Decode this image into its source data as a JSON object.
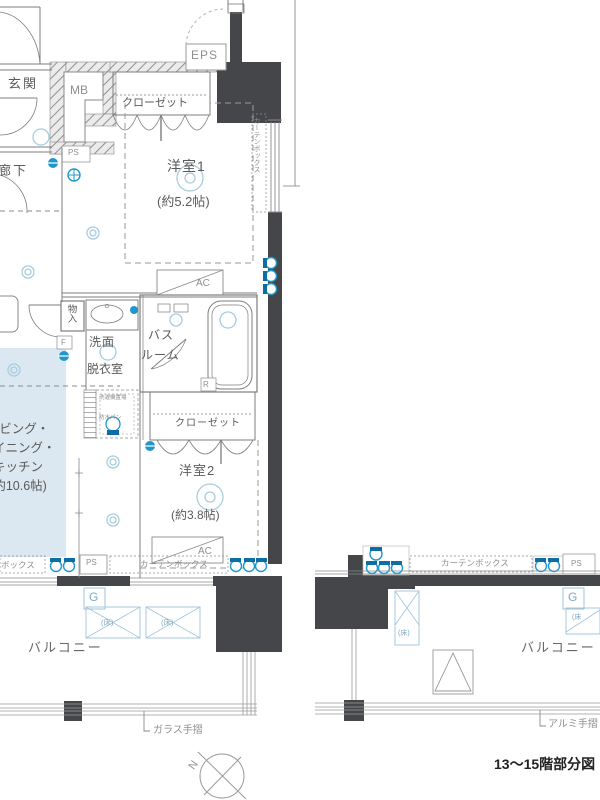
{
  "plan": {
    "caption": "13〜15階部分図",
    "compass_n": "N",
    "rooms": {
      "genkan": "玄関",
      "hallway": "廊下",
      "mb": "MB",
      "eps": "EPS",
      "closet1": "クローゼット",
      "room1": "洋室1",
      "room1_size": "(約5.2帖)",
      "monoire": "物入",
      "senmen": "洗面",
      "datsui": "脱衣室",
      "bath_line1": "バス",
      "bath_line2": "ルーム",
      "washer_area": "洗濯機置場",
      "washer_pan": "防水パン",
      "closet2": "クローゼット",
      "room2": "洋室2",
      "room2_size": "(約3.8帖)",
      "ldk_line1": "リビング・",
      "ldk_line2": "ダイニング・",
      "ldk_line3": "キッチン",
      "ldk_line4": "(約10.6帖)",
      "balcony_left": "バルコニー",
      "balcony_right": "バルコニー"
    },
    "labels": {
      "ps_top": "PS",
      "ps_bottom_left": "PS",
      "ps_bottom_right": "PS",
      "f_mark": "F",
      "r_mark": "R",
      "g_left": "G",
      "g_right": "G",
      "ac_room1": "AC",
      "ac_room2": "AC",
      "floor_hatch": "(床)",
      "floor_hatch_partial": "(床",
      "curtainbox_room1_side": "カーテンボックス",
      "curtainbox_room2_bottom": "カーテンボックス",
      "curtainbox_left_partial": "ボックス",
      "curtainbox_right": "カーテンボックス",
      "glass_handrail": "ガラス手摺",
      "aluminum_handrail": "アルミ手摺"
    },
    "colors": {
      "wall_dark": "#45464a",
      "line_gray": "#8a8a8a",
      "symbol_blue": "#1f97cc",
      "symbol_blue_dark": "#0d6ea6",
      "light_blue_line": "#9fc4da",
      "ldk_tint": "#dce8f1"
    }
  }
}
